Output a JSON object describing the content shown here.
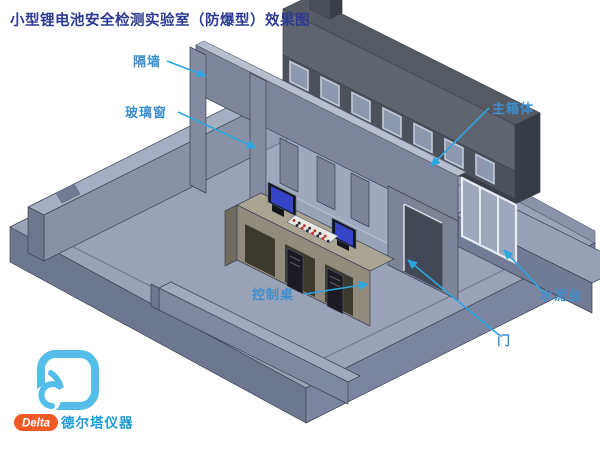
{
  "title": "小型锂电池安全检测实验室（防爆型）效果图",
  "labels": {
    "partition_wall": "隔墙",
    "glass_window": "玻璃窗",
    "main_box": "主箱体",
    "control_desk": "控制桌",
    "door": "门",
    "cement_platform": "水泥台"
  },
  "logo": {
    "brand": "Delta",
    "brand_cn": "德尔塔仪器"
  },
  "colors": {
    "leader": "#2aa7e0",
    "title": "#2c3a92",
    "label": "#3e8fd0",
    "brand_orange": "#f15a24",
    "brand_cn_blue": "#1d9bd7",
    "floor_top": "#99a2b7",
    "wall": "#7e8599",
    "main_box_body": "#5d616b",
    "desk_top": "#aaa593",
    "monitor_screen": "#3644c8"
  }
}
